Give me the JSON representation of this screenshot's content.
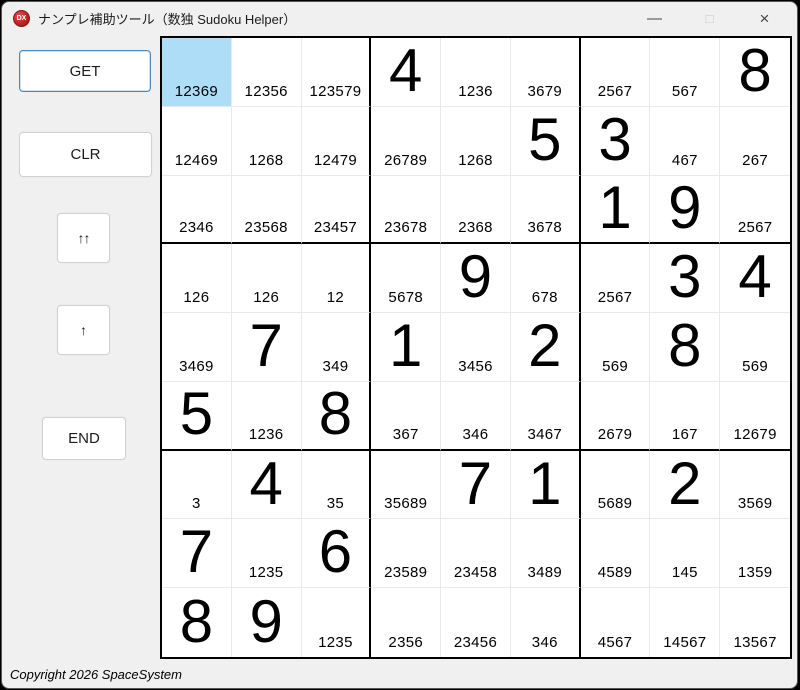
{
  "window": {
    "title": "ナンプレ補助ツール（数独 Sudoku Helper）",
    "icon_text": "DX",
    "controls": {
      "minimize": "—",
      "maximize": "□",
      "close": "×"
    }
  },
  "sidebar": {
    "buttons": [
      {
        "id": "get",
        "label": "GET"
      },
      {
        "id": "clr",
        "label": "CLR"
      },
      {
        "id": "upup",
        "label": "↑↑"
      },
      {
        "id": "up",
        "label": "↑"
      },
      {
        "id": "end",
        "label": "END"
      }
    ]
  },
  "colors": {
    "selected_cell": "#aeddf7",
    "block_border": "#000000",
    "cell_border": "#e9e9e9",
    "focus_border": "#4d88b5"
  },
  "grid": {
    "selected": {
      "row": 1,
      "col": 1
    },
    "rows": [
      [
        {
          "c": "12369",
          "sel": true
        },
        {
          "c": "12356"
        },
        {
          "c": "123579"
        },
        {
          "b": "4"
        },
        {
          "c": "1236"
        },
        {
          "c": "3679"
        },
        {
          "c": "2567"
        },
        {
          "c": "567"
        },
        {
          "b": "8"
        }
      ],
      [
        {
          "c": "12469"
        },
        {
          "c": "1268"
        },
        {
          "c": "12479"
        },
        {
          "c": "26789"
        },
        {
          "c": "1268"
        },
        {
          "b": "5"
        },
        {
          "b": "3"
        },
        {
          "c": "467"
        },
        {
          "c": "267"
        }
      ],
      [
        {
          "c": "2346"
        },
        {
          "c": "23568"
        },
        {
          "c": "23457"
        },
        {
          "c": "23678"
        },
        {
          "c": "2368"
        },
        {
          "c": "3678"
        },
        {
          "b": "1"
        },
        {
          "b": "9"
        },
        {
          "c": "2567"
        }
      ],
      [
        {
          "c": "126"
        },
        {
          "c": "126"
        },
        {
          "c": "12"
        },
        {
          "c": "5678"
        },
        {
          "b": "9"
        },
        {
          "c": "678"
        },
        {
          "c": "2567"
        },
        {
          "b": "3"
        },
        {
          "b": "4"
        }
      ],
      [
        {
          "c": "3469"
        },
        {
          "b": "7"
        },
        {
          "c": "349"
        },
        {
          "b": "1"
        },
        {
          "c": "3456"
        },
        {
          "b": "2"
        },
        {
          "c": "569"
        },
        {
          "b": "8"
        },
        {
          "c": "569"
        }
      ],
      [
        {
          "b": "5"
        },
        {
          "c": "1236"
        },
        {
          "b": "8"
        },
        {
          "c": "367"
        },
        {
          "c": "346"
        },
        {
          "c": "3467"
        },
        {
          "c": "2679"
        },
        {
          "c": "167"
        },
        {
          "c": "12679"
        }
      ],
      [
        {
          "c": "3"
        },
        {
          "b": "4"
        },
        {
          "c": "35"
        },
        {
          "c": "35689"
        },
        {
          "b": "7"
        },
        {
          "b": "1"
        },
        {
          "c": "5689"
        },
        {
          "b": "2"
        },
        {
          "c": "3569"
        }
      ],
      [
        {
          "b": "7"
        },
        {
          "c": "1235"
        },
        {
          "b": "6"
        },
        {
          "c": "23589"
        },
        {
          "c": "23458"
        },
        {
          "c": "3489"
        },
        {
          "c": "4589"
        },
        {
          "c": "145"
        },
        {
          "c": "1359"
        }
      ],
      [
        {
          "b": "8"
        },
        {
          "b": "9"
        },
        {
          "c": "1235"
        },
        {
          "c": "2356"
        },
        {
          "c": "23456"
        },
        {
          "c": "346"
        },
        {
          "c": "4567"
        },
        {
          "c": "14567"
        },
        {
          "c": "13567"
        }
      ]
    ]
  },
  "footer": {
    "copyright": "Copyright 2026 SpaceSystem"
  }
}
